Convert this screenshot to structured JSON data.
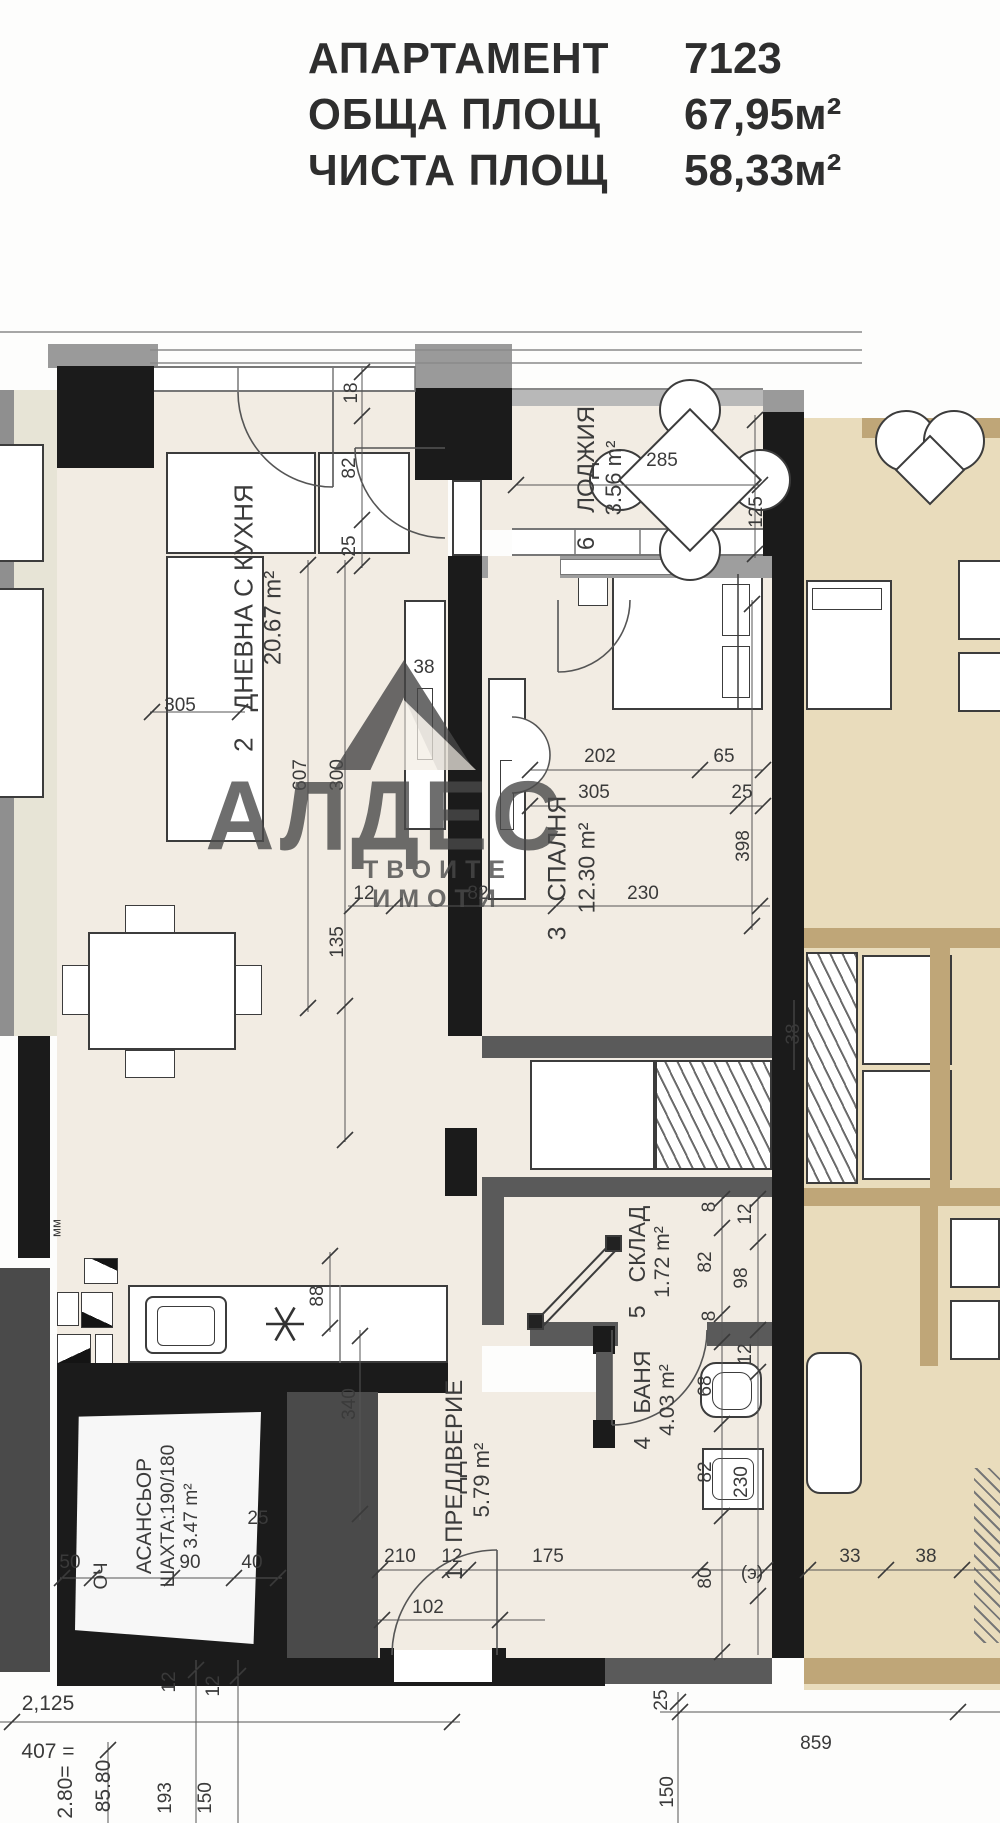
{
  "header": {
    "rows": [
      {
        "label": "АПАРТАМЕНТ",
        "value": "7123"
      },
      {
        "label": "ОБЩА ПЛОЩ",
        "value": "67,95м²"
      },
      {
        "label": "ЧИСТА ПЛОЩ",
        "value": "58,33м²"
      }
    ]
  },
  "watermark": {
    "brand": "АЛДЕС",
    "tagline": "ТВОИТЕ ИМОТИ"
  },
  "rooms": [
    {
      "key": "living",
      "number": "2",
      "name": "ДНЕВНА С КУХНЯ",
      "area": "20.67 m²"
    },
    {
      "key": "loggia",
      "number": "6",
      "name": "ЛОДЖИЯ",
      "area": "3.56 m²"
    },
    {
      "key": "bedroom",
      "number": "3",
      "name": "СПАЛНЯ",
      "area": "12.30 m²"
    },
    {
      "key": "sklad",
      "number": "5",
      "name": "СКЛАД",
      "area": "1.72 m²"
    },
    {
      "key": "banya",
      "number": "4",
      "name": "БАНЯ",
      "area": "4.03 m²"
    },
    {
      "key": "hall",
      "number": "1",
      "name": "ПРЕДДВЕРИЕ",
      "area": "5.79 m²"
    },
    {
      "key": "elevator",
      "number": "",
      "name": "АСАНСЬОР",
      "detail": "ШАХТА:190/180",
      "area": "3.47 m²"
    },
    {
      "key": "mm",
      "number": "",
      "name": "мм",
      "area": ""
    }
  ],
  "dimensions": [
    {
      "id": "d01",
      "text": "18"
    },
    {
      "id": "d02",
      "text": "82"
    },
    {
      "id": "d03",
      "text": "25"
    },
    {
      "id": "d04",
      "text": "285"
    },
    {
      "id": "d05",
      "text": "125"
    },
    {
      "id": "d06",
      "text": "305"
    },
    {
      "id": "d07",
      "text": "607"
    },
    {
      "id": "d08",
      "text": "300"
    },
    {
      "id": "d09",
      "text": "135"
    },
    {
      "id": "d10",
      "text": "38"
    },
    {
      "id": "d11",
      "text": "202"
    },
    {
      "id": "d12",
      "text": "65"
    },
    {
      "id": "d13",
      "text": "305"
    },
    {
      "id": "d14",
      "text": "25"
    },
    {
      "id": "d15",
      "text": "398"
    },
    {
      "id": "d16",
      "text": "12"
    },
    {
      "id": "d17",
      "text": "82"
    },
    {
      "id": "d18",
      "text": "230"
    },
    {
      "id": "d19",
      "text": "8"
    },
    {
      "id": "d20",
      "text": "82"
    },
    {
      "id": "d21",
      "text": "8"
    },
    {
      "id": "d22",
      "text": "12"
    },
    {
      "id": "d23",
      "text": "98"
    },
    {
      "id": "d24",
      "text": "68"
    },
    {
      "id": "d25",
      "text": "82"
    },
    {
      "id": "d26",
      "text": "12"
    },
    {
      "id": "d27",
      "text": "230"
    },
    {
      "id": "d28",
      "text": "80"
    },
    {
      "id": "d29",
      "text": "(э)"
    },
    {
      "id": "d30",
      "text": "88"
    },
    {
      "id": "d31",
      "text": "340"
    },
    {
      "id": "d32",
      "text": "210"
    },
    {
      "id": "d33",
      "text": "12"
    },
    {
      "id": "d34",
      "text": "175"
    },
    {
      "id": "d35",
      "text": "102"
    },
    {
      "id": "d36",
      "text": "50"
    },
    {
      "id": "d37",
      "text": "ОЧ"
    },
    {
      "id": "d38",
      "text": "90"
    },
    {
      "id": "d39",
      "text": "40"
    },
    {
      "id": "d40",
      "text": "25"
    },
    {
      "id": "d41",
      "text": "33"
    },
    {
      "id": "d42",
      "text": "38"
    },
    {
      "id": "d43",
      "text": "38"
    },
    {
      "id": "d44",
      "text": "12"
    },
    {
      "id": "d45",
      "text": "12"
    },
    {
      "id": "d46",
      "text": "2,125"
    },
    {
      "id": "d47",
      "text": "407 ="
    },
    {
      "id": "d48",
      "text": "2.80="
    },
    {
      "id": "d49",
      "text": "85.80"
    },
    {
      "id": "d50",
      "text": "193"
    },
    {
      "id": "d51",
      "text": "150"
    },
    {
      "id": "d52",
      "text": "150"
    },
    {
      "id": "d53",
      "text": "859"
    },
    {
      "id": "d54",
      "text": "25"
    }
  ]
}
